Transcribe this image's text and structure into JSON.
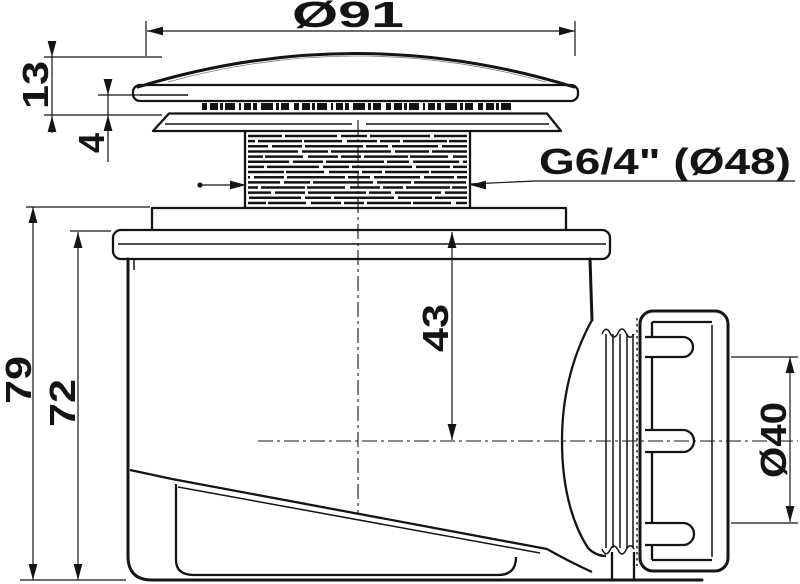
{
  "drawing": {
    "type": "technical-dimension-drawing",
    "subject": "shower-drain-trap-side-view",
    "colors": {
      "ink": "#141414",
      "paper": "#ffffff"
    },
    "labels": {
      "cap_diameter": "Ø91",
      "cap_height": "13",
      "rim_gap": "4",
      "thread_spec": "G6/4\" (Ø48)",
      "flange_to_axis_depth": "43",
      "total_height": "79",
      "body_height": "72",
      "outlet_diameter": "Ø40"
    }
  }
}
